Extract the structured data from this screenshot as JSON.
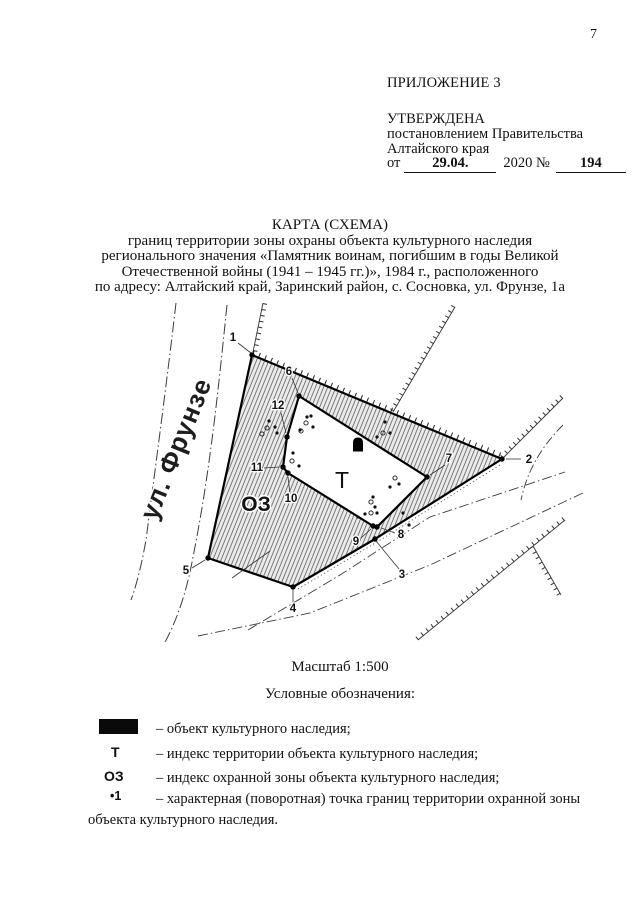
{
  "page_number": "7",
  "header": {
    "appendix": "ПРИЛОЖЕНИЕ 3",
    "approved": "УТВЕРЖДЕНА",
    "by_line1": "постановлением Правительства",
    "by_line2": "Алтайского края",
    "from_label": "от",
    "date": "29.04.",
    "year_no": "2020 №",
    "number": "194"
  },
  "title": {
    "line1": "КАРТА (СХЕМА)",
    "line2": "границ территории зоны охраны объекта культурного наследия",
    "line3": "регионального значения «Памятник воинам, погибшим в годы Великой",
    "line4": "Отечественной войны (1941 – 1945 гг.)», 1984 г., расположенного",
    "line5": "по адресу: Алтайский край, Заринский район, с. Сосновка, ул. Фрунзе, 1а"
  },
  "map": {
    "street": "ул. Фрунзе",
    "zone": "ОЗ",
    "territory": "Т",
    "points": [
      {
        "n": "1"
      },
      {
        "n": "2"
      },
      {
        "n": "3"
      },
      {
        "n": "4"
      },
      {
        "n": "5"
      },
      {
        "n": "6"
      },
      {
        "n": "7"
      },
      {
        "n": "8"
      },
      {
        "n": "9"
      },
      {
        "n": "10"
      },
      {
        "n": "11"
      },
      {
        "n": "12"
      }
    ]
  },
  "scale": "Масштаб 1:500",
  "legend": {
    "heading": "Условные обозначения:",
    "items": [
      {
        "symbol": "",
        "text": "– объект культурного наследия;"
      },
      {
        "symbol": "Т",
        "text": "– индекс территории объекта культурного наследия;"
      },
      {
        "symbol": "ОЗ",
        "text": "– индекс охранной зоны объекта культурного наследия;"
      },
      {
        "symbol": "•1",
        "text": "– характерная (поворотная) точка границ территории охранной зоны"
      }
    ],
    "continuation": "объекта культурного наследия."
  },
  "colors": {
    "ink": "#111111",
    "hatch_line": "#4a4a4a",
    "hatch_bg": "#ebebeb"
  }
}
